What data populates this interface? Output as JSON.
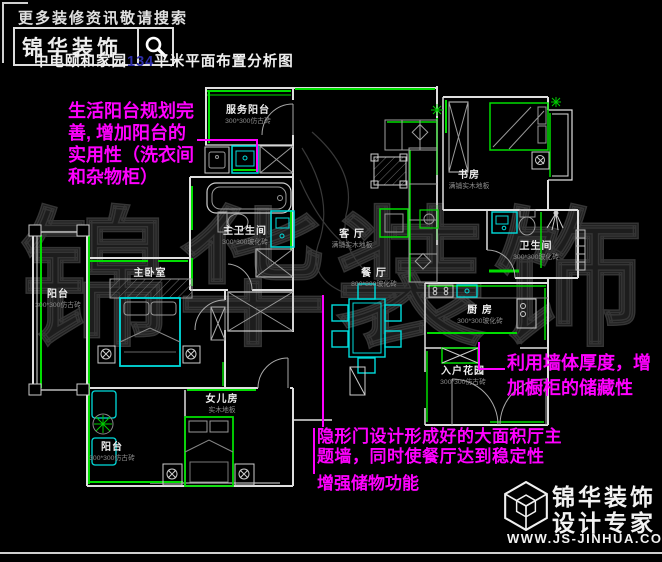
{
  "header": {
    "slogan": "更多装修资讯敬请搜索",
    "brand": "锦华装饰",
    "title_prefix": "中电颐和家园",
    "title_area": "134",
    "title_suffix": "平米平面布置分析图"
  },
  "watermark": "锦华装饰",
  "rooms": {
    "service_balcony": {
      "name": "服务阳台",
      "material": "300*300仿古砖"
    },
    "master_bath": {
      "name": "主卫生间",
      "material": "300*300玻化砖"
    },
    "living": {
      "name": "客 厅",
      "material": "满铺实木地板"
    },
    "dining": {
      "name": "餐 厅",
      "material": "800*800玻化砖"
    },
    "master_bedroom": {
      "name": "主卧室"
    },
    "balcony_left": {
      "name": "阳台",
      "material": "300*300仿古砖"
    },
    "daughter_room": {
      "name": "女儿房",
      "material": "实木地板"
    },
    "balcony_bottom": {
      "name": "阳台",
      "material": "300*300仿古砖"
    },
    "study": {
      "name": "书房",
      "material": "满铺实木地板"
    },
    "bathroom": {
      "name": "卫生间",
      "material": "300*300玻化砖"
    },
    "kitchen": {
      "name": "厨 房",
      "material": "300*300玻化砖"
    },
    "entry_garden": {
      "name": "入户花园",
      "material": "300*300仿古砖"
    }
  },
  "annotations": {
    "balcony_note": {
      "lines": [
        "生活阳台规划完",
        "善, 增加阳台的",
        "实用性（洗衣间",
        "和杂物柜）"
      ]
    },
    "cabinet_note": {
      "lines": [
        "利用墙体厚度，增",
        "加橱柜的储藏性"
      ]
    },
    "door_note": {
      "lines": [
        "隐形门设计形成好的大面积厅主",
        "题墙，同时使餐厅达到稳定性"
      ]
    },
    "storage_note": {
      "lines": [
        "增强储物功能"
      ]
    }
  },
  "logo": {
    "brand": "锦华装饰",
    "tagline": "设计专家",
    "website": "WWW.JS-JINHUA.COM"
  },
  "colors": {
    "wall": "#dfdfdf",
    "accent_green": "#00dd00",
    "furniture_cyan": "#00dcdc",
    "annotation_pink": "#ff00ff",
    "material_gray": "#8d8d8d",
    "area_number_blue": "#2d2da8"
  }
}
